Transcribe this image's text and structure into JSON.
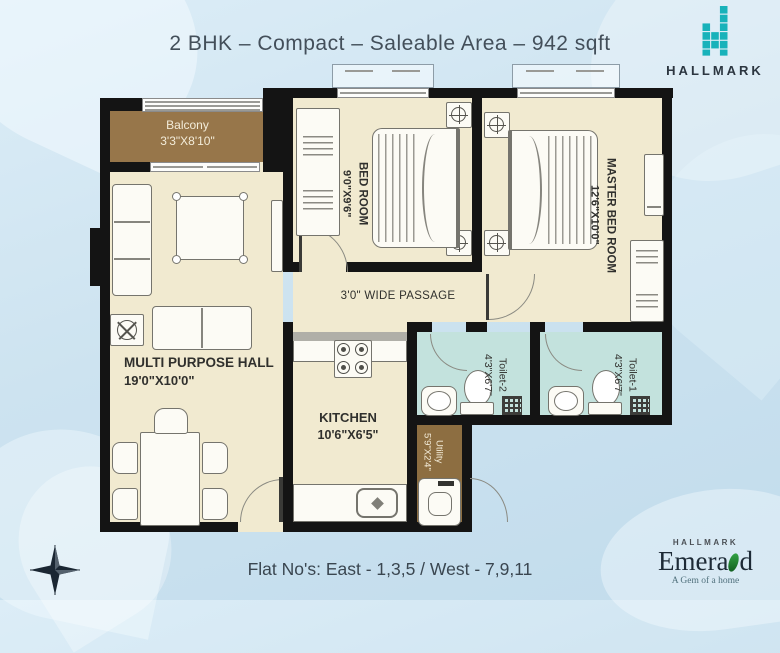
{
  "title": "2 BHK – Compact – Saleable Area – 942 sqft",
  "brand": {
    "name": "HALLMARK"
  },
  "rooms": {
    "balcony": {
      "name": "Balcony",
      "dim": "3'3\"X8'10\""
    },
    "bedroom": {
      "name": "BED ROOM",
      "dim": "9'0\"X9'6\""
    },
    "master_bedroom": {
      "name": "MASTER BED ROOM",
      "dim": "12'6\"X10'0\""
    },
    "hall": {
      "name": "MULTI PURPOSE HALL",
      "dim": "19'0\"X10'0\""
    },
    "passage": {
      "name": "3'0\" WIDE PASSAGE"
    },
    "kitchen": {
      "name": "KITCHEN",
      "dim": "10'6\"X6'5\""
    },
    "toilet2": {
      "name": "Toilet-2",
      "dim": "4'3\"X6'7\""
    },
    "toilet1": {
      "name": "Toilet-1",
      "dim": "4'3\"X6'7\""
    },
    "utility": {
      "name": "Utility",
      "dim": "5'9\"X2'4\""
    }
  },
  "footer": {
    "flat_nos": "Flat No's:  East - 1,3,5 / West - 7,9,11"
  },
  "developer_logo": {
    "brand": "HALLMARK",
    "project_pre": "Emera",
    "project_post": "d",
    "tagline": "A Gem of a home"
  },
  "colors": {
    "wall": "#141414",
    "floor_cream": "#f1ead0",
    "balcony_brown": "#97764a",
    "toilet_blue": "#c3e2dd",
    "brand_teal": "#18b2ba",
    "text_dark": "#333a42"
  }
}
